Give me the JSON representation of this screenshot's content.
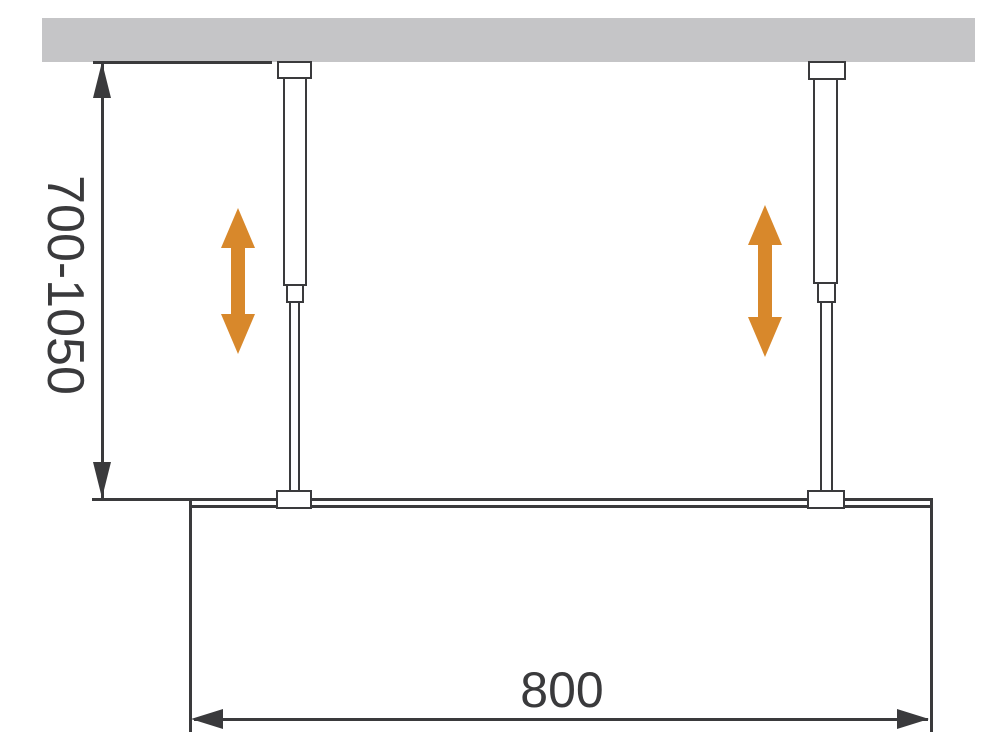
{
  "diagram": {
    "labels": {
      "height_range": "700-1050",
      "width": "800"
    },
    "colors": {
      "line": "#3a3a3c",
      "wall": "#c5c5c7",
      "accent": "#d8882b",
      "background": "#ffffff"
    },
    "icons": {
      "adjustability": "double-vertical-arrow-icon",
      "dimension_arrows": "dimension-arrowhead-icon"
    }
  }
}
